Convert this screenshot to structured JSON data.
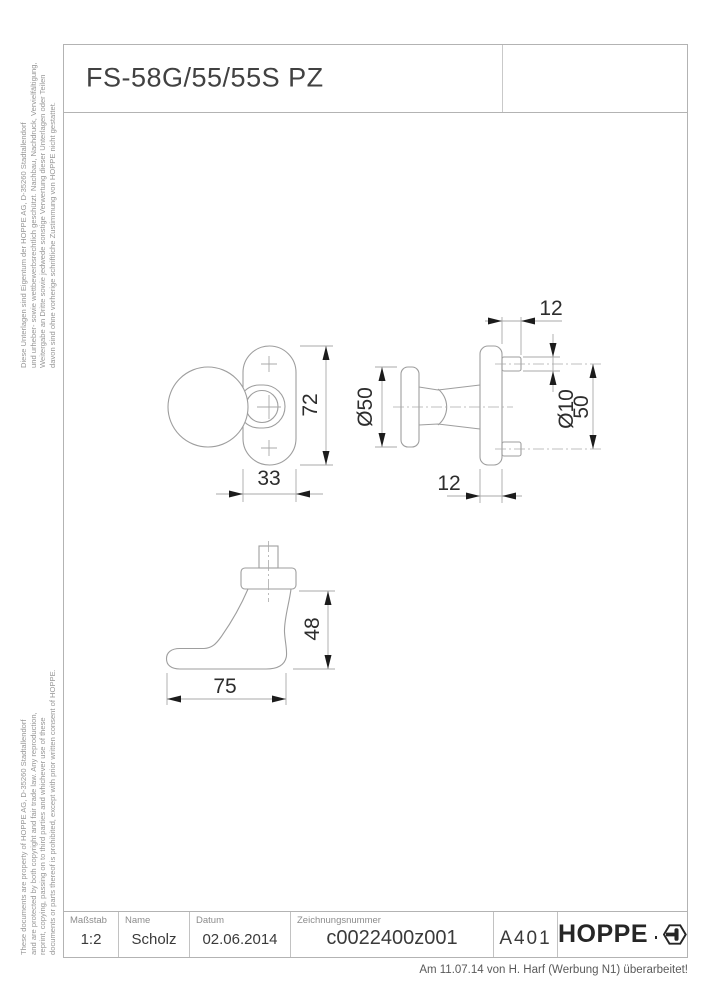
{
  "sheet": {
    "title": "FS-58G/55/55S PZ",
    "legal_note_german": "Diese Unterlagen sind Eigentum der HOPPE AG, D-35260 Stadtallendorf\nund urheber- sowie wettbewerbsrechtlich geschützt. Nachbau, Nachdruck, Vervielfältigung,\nWeitergabe an Dritte sowie jedwede sonstige Verwertung dieser Unterlagen oder Teilen\ndavon sind ohne vorherige schriftliche Zustimmung von HOPPE nicht gestattet.",
    "legal_note_english": "These documents are property of HOPPE AG, D-35260 Stadtallendorf\nand are protected by both copyright and fair trade law. Any reproduction,\nreprint, copying, passing on to third parties and whichever use of these\ndocuments or parts thereof is prohibited, except with prior written consent of HOPPE.",
    "revision_note": "Am 11.07.14 von H. Harf (Werbung N1) überarbeitet!"
  },
  "title_block": {
    "scale": {
      "label": "Maßstab",
      "value": "1:2"
    },
    "name": {
      "label": "Name",
      "value": "Scholz"
    },
    "date": {
      "label": "Datum",
      "value": "02.06.2014"
    },
    "drawing_number": {
      "label": "Zeichnungsnummer",
      "value": "c0022400z001"
    },
    "format": {
      "value": "A401"
    },
    "brand": {
      "wordmark": "HOPPE"
    }
  },
  "drawing": {
    "dims": {
      "rose_height": "72",
      "rose_width": "33",
      "knob_diameter": "Ø50",
      "pin_length": "12",
      "rose_depth": "12",
      "pin_diameter": "Ø10",
      "pin_spacing": "50",
      "lever_height": "48",
      "lever_length": "75"
    }
  },
  "colors": {
    "outline": "#9e9e9e",
    "dimension_line": "#a9a9a9",
    "arrow": "#1c1c1c",
    "dimension_text": "#2d2d2d",
    "frame": "#b3b3b3",
    "legal_text": "#969696",
    "brand_text": "#262626"
  }
}
